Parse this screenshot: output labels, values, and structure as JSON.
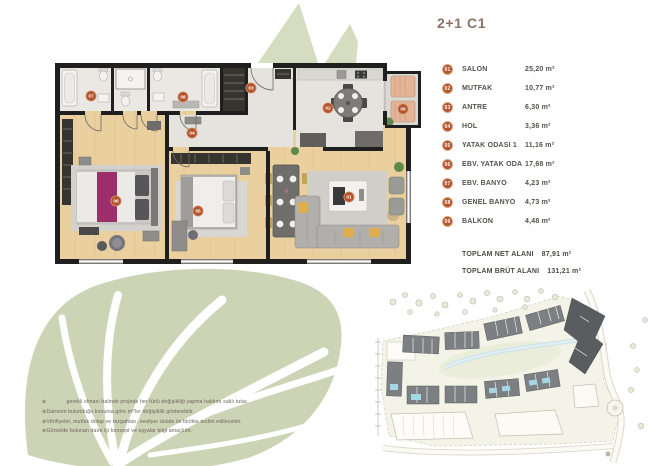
{
  "title": "2+1 C1",
  "legend": [
    {
      "num": "01",
      "label": "SALON",
      "area": "25,20 m²"
    },
    {
      "num": "02",
      "label": "MUTFAK",
      "area": "10,77 m²"
    },
    {
      "num": "03",
      "label": "ANTRE",
      "area": "6,30 m²"
    },
    {
      "num": "04",
      "label": "HOL",
      "area": "3,36 m²"
    },
    {
      "num": "05",
      "label": "YATAK ODASI 1",
      "area": "11,16 m²"
    },
    {
      "num": "06",
      "label": "EBV. YATAK ODA",
      "area": "17,68 m²"
    },
    {
      "num": "07",
      "label": "EBV. BANYO",
      "area": "4,23 m²"
    },
    {
      "num": "08",
      "label": "GENEL BANYO",
      "area": "4,73 m²"
    },
    {
      "num": "09",
      "label": "BALKON",
      "area": "4,48 m²"
    }
  ],
  "totals": [
    {
      "label": "TOPLAM NET  ALANI",
      "area": "87,91 m²"
    },
    {
      "label": "TOPLAM BRÜT  ALANI",
      "area": "131,21 m²"
    }
  ],
  "plan": {
    "badges": [
      "01",
      "02",
      "03",
      "04",
      "05",
      "06",
      "07",
      "08",
      "09"
    ]
  },
  "disclaimer": [
    "⊛             gerekli olması halinde projede her türlü değişikliği yapma hakkını saklı tutar.",
    "⊛Dairenin bulunduğu konuma göre m²'ler değişiklik gösterebilir.",
    "⊛Vitrifiyeler, mutfak dolap ve tezgahları, vestiyer dolabı ile birlikte teslim edilecektir.",
    "⊛Görselde bulunan daire içi konsept ve eşyalar bilgi amaçlıdır."
  ],
  "colors": {
    "accent": "#b5532c",
    "title": "#8b7266",
    "text": "#55504b",
    "leaf": "#cdd4b6",
    "wall": "#1f1f1f",
    "wood": "#eacf9f",
    "highlight_units": "#a5d8e6",
    "bed_runner": "#9c2e6b"
  }
}
